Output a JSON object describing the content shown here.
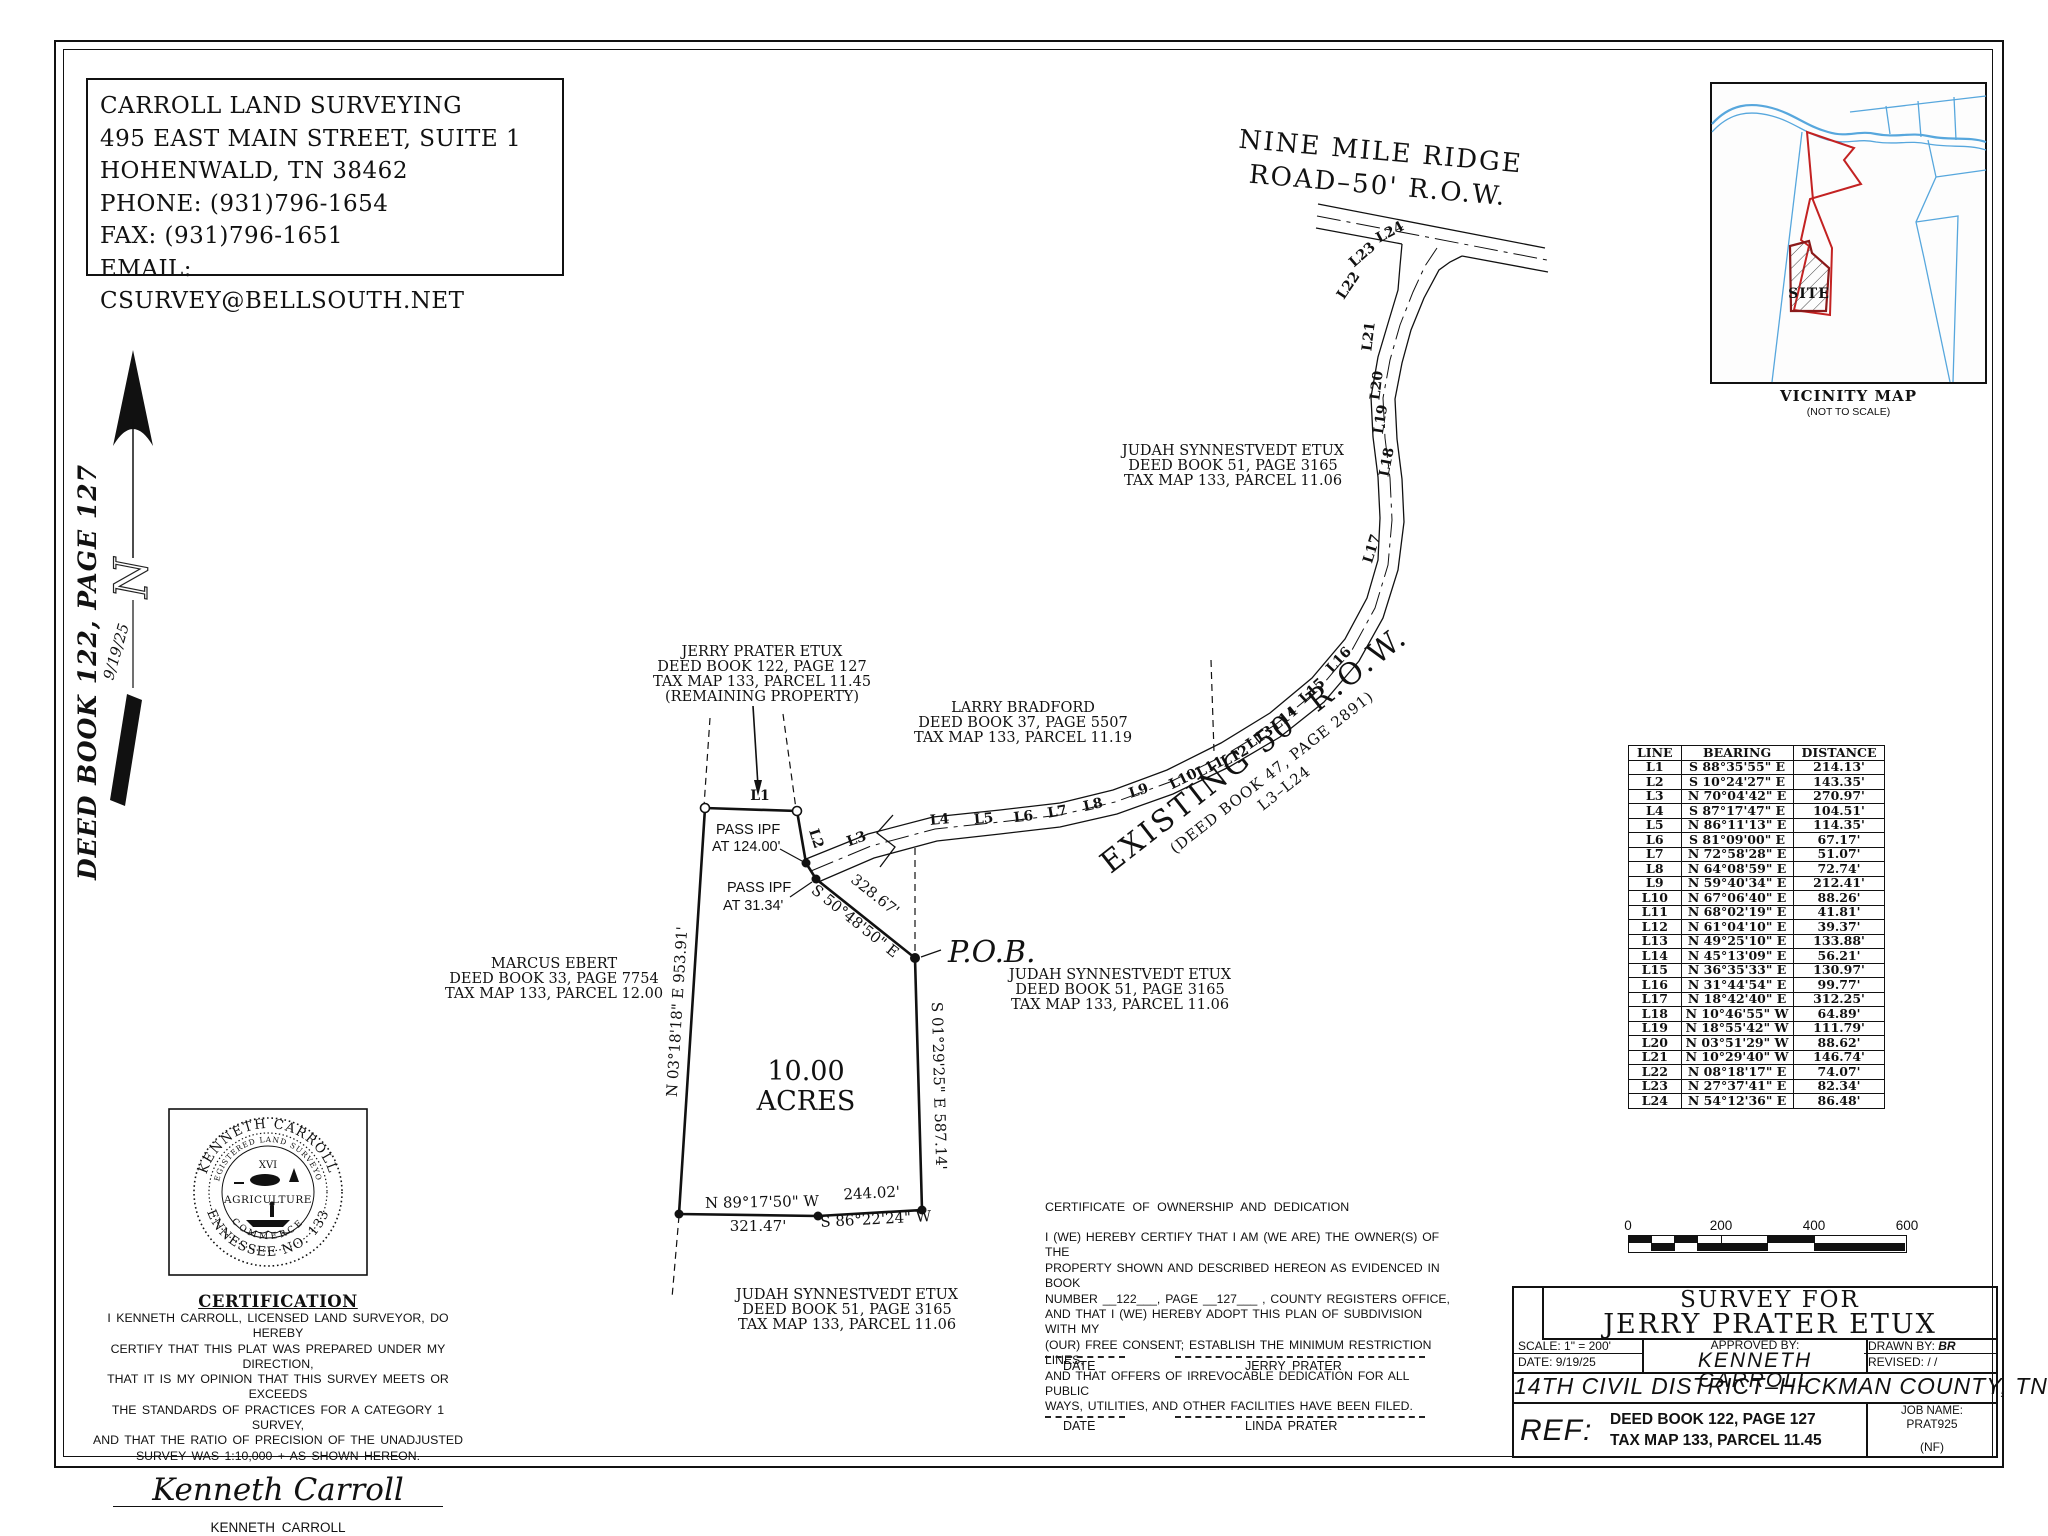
{
  "firm": {
    "name": "CARROLL LAND SURVEYING",
    "address1": "495 EAST MAIN STREET, SUITE 1",
    "address2": "HOHENWALD, TN 38462",
    "phone": "PHONE: (931)796-1654",
    "fax": "FAX: (931)796-1651",
    "email": "EMAIL: CSURVEY@BELLSOUTH.NET"
  },
  "north": {
    "letter": "N",
    "date": "9/19/25",
    "deed_ref": "DEED BOOK 122, PAGE 127"
  },
  "road": {
    "name1": "NINE MILE RIDGE",
    "name2": "ROAD–50' R.O.W.",
    "existing1": "EXISTING 50' R.O.W.",
    "existing2": "(DEED BOOK 47, PAGE 2891)",
    "existing3": "L3–L24"
  },
  "vicinity": {
    "site": "SITE",
    "title": "VICINITY MAP",
    "subtitle": "(NOT TO SCALE)"
  },
  "owners": {
    "jerry": [
      "JERRY PRATER ETUX",
      "DEED BOOK 122, PAGE 127",
      "TAX MAP 133, PARCEL 11.45",
      "(REMAINING PROPERTY)"
    ],
    "larry": [
      "LARRY BRADFORD",
      "DEED BOOK 37, PAGE 5507",
      "TAX MAP 133, PARCEL 11.19"
    ],
    "judah_top": [
      "JUDAH SYNNESTVEDT ETUX",
      "DEED BOOK 51, PAGE 3165",
      "TAX MAP 133, PARCEL 11.06"
    ],
    "judah_mid": [
      "JUDAH SYNNESTVEDT ETUX",
      "DEED BOOK 51, PAGE 3165",
      "TAX MAP 133, PARCEL 11.06"
    ],
    "judah_bottom": [
      "JUDAH SYNNESTVEDT ETUX",
      "DEED BOOK 51, PAGE 3165",
      "TAX MAP 133, PARCEL 11.06"
    ],
    "marcus": [
      "MARCUS EBERT",
      "DEED BOOK 33, PAGE 7754",
      "TAX MAP 133, PARCEL 12.00"
    ]
  },
  "parcel": {
    "acres1": "10.00",
    "acres2": "ACRES",
    "pob": "P.O.B.",
    "pass1a": "PASS IPF",
    "pass1b": "AT 124.00'",
    "pass2a": "PASS IPF",
    "pass2b": "AT 31.34'",
    "west": "N 03°18'18\" E  953.91'",
    "east": "S 01°29'25\" E  587.14'",
    "diag_dist": "328.67'",
    "diag_bearing": "S 50°48'50\" E",
    "south1": "N 89°17'50\" W",
    "south1_dist": "321.47'",
    "south2_dist": "244.02'",
    "south2": "S 86°22'24\" W"
  },
  "segments": [
    "L1",
    "L2",
    "L3",
    "L4",
    "L5",
    "L6",
    "L7",
    "L8",
    "L9",
    "L10",
    "L11",
    "L12",
    "L13",
    "L14",
    "L15",
    "L16",
    "L17",
    "L18",
    "L19",
    "L20",
    "L21",
    "L22",
    "L23",
    "L24"
  ],
  "line_table": {
    "headers": [
      "LINE",
      "BEARING",
      "DISTANCE"
    ],
    "rows": [
      [
        "L1",
        "S 88°35'55\" E",
        "214.13'"
      ],
      [
        "L2",
        "S 10°24'27\" E",
        "143.35'"
      ],
      [
        "L3",
        "N 70°04'42\" E",
        "270.97'"
      ],
      [
        "L4",
        "S 87°17'47\" E",
        "104.51'"
      ],
      [
        "L5",
        "N 86°11'13\" E",
        "114.35'"
      ],
      [
        "L6",
        "S 81°09'00\" E",
        "67.17'"
      ],
      [
        "L7",
        "N 72°58'28\" E",
        "51.07'"
      ],
      [
        "L8",
        "N 64°08'59\" E",
        "72.74'"
      ],
      [
        "L9",
        "N 59°40'34\" E",
        "212.41'"
      ],
      [
        "L10",
        "N 67°06'40\" E",
        "88.26'"
      ],
      [
        "L11",
        "N 68°02'19\" E",
        "41.81'"
      ],
      [
        "L12",
        "N 61°04'10\" E",
        "39.37'"
      ],
      [
        "L13",
        "N 49°25'10\" E",
        "133.88'"
      ],
      [
        "L14",
        "N 45°13'09\" E",
        "56.21'"
      ],
      [
        "L15",
        "N 36°35'33\" E",
        "130.97'"
      ],
      [
        "L16",
        "N 31°44'54\" E",
        "99.77'"
      ],
      [
        "L17",
        "N 18°42'40\" E",
        "312.25'"
      ],
      [
        "L18",
        "N 10°46'55\" W",
        "64.89'"
      ],
      [
        "L19",
        "N 18°55'42\" W",
        "111.79'"
      ],
      [
        "L20",
        "N 03°51'29\" W",
        "88.62'"
      ],
      [
        "L21",
        "N 10°29'40\" W",
        "146.74'"
      ],
      [
        "L22",
        "N 08°18'17\" E",
        "74.07'"
      ],
      [
        "L23",
        "N 27°37'41\" E",
        "82.34'"
      ],
      [
        "L24",
        "N 54°12'36\" E",
        "86.48'"
      ]
    ]
  },
  "seal": {
    "name": "KENNETH CARROLL",
    "ring_top": "REGISTERED LAND SURVEYOR",
    "ring_bottom": "COMMERCE",
    "center_top": "XVI",
    "center_mid": "AGRICULTURE",
    "bottom": "TENNESSEE NO. 1335"
  },
  "certification": {
    "title": "CERTIFICATION",
    "lines": [
      "I KENNETH CARROLL, LICENSED LAND SURVEYOR, DO HEREBY",
      "CERTIFY THAT THIS PLAT WAS PREPARED UNDER MY DIRECTION,",
      "THAT IT IS MY OPINION THAT THIS SURVEY MEETS OR EXCEEDS",
      "THE STANDARDS OF PRACTICES FOR A CATEGORY 1 SURVEY,",
      "AND THAT THE RATIO OF PRECISION OF THE UNADJUSTED",
      "SURVEY WAS 1:10,000 + AS SHOWN HEREON."
    ],
    "signature": "Kenneth Carroll",
    "name": "KENNETH CARROLL",
    "reg": "TENN. REG NO. 1335"
  },
  "dedication": {
    "title": "CERTIFICATE OF OWNERSHIP AND DEDICATION",
    "lines": [
      "I (WE) HEREBY CERTIFY THAT I AM (WE ARE) THE OWNER(S) OF THE",
      "PROPERTY SHOWN AND DESCRIBED HEREON AS EVIDENCED IN BOOK",
      "NUMBER __122___, PAGE __127___ , COUNTY REGISTERS OFFICE,",
      "AND THAT I (WE) HEREBY ADOPT THIS PLAN OF SUBDIVISION WITH MY",
      "(OUR) FREE CONSENT; ESTABLISH THE MINIMUM RESTRICTION LINES,",
      "AND THAT OFFERS OF IRREVOCABLE DEDICATION FOR ALL PUBLIC",
      "WAYS, UTILITIES, AND OTHER FACILITIES HAVE BEEN FILED."
    ],
    "date_label": "DATE",
    "owner1": "JERRY PRATER",
    "owner2": "LINDA PRATER"
  },
  "scalebar": {
    "t0": "0",
    "t1": "200",
    "t2": "400",
    "t3": "600"
  },
  "titleblock": {
    "line1": "SURVEY FOR",
    "line2": "JERRY PRATER ETUX",
    "scale_label": "SCALE: 1\" = 200'",
    "date_label": "DATE: 9/19/25",
    "approved_label": "APPROVED BY:",
    "approved_name": "KENNETH CARROLL",
    "drawn_label": "DRAWN BY:",
    "drawn_value": "BR",
    "revised_label": "REVISED:",
    "revised_value": "/   /",
    "district": "14TH CIVIL DISTRICT–HICKMAN COUNTY, TN",
    "ref_label": "REF:",
    "ref1": "DEED BOOK 122, PAGE 127",
    "ref2": "TAX MAP 133, PARCEL 11.45",
    "job_label": "JOB NAME:",
    "job_value": "PRAT925",
    "job_note": "(NF)"
  }
}
